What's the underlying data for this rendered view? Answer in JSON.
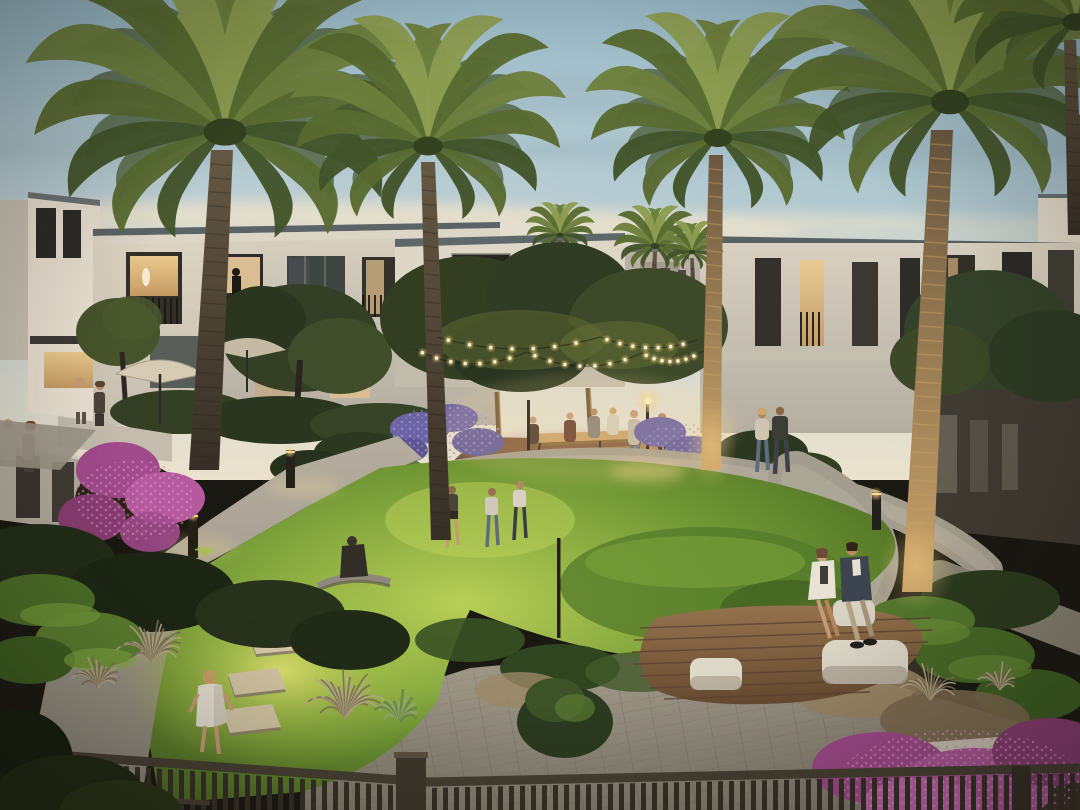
{
  "scene": {
    "type": "architectural-rendering",
    "setting": "residential community courtyard at dusk",
    "sky": "dusk sky with soft clouds",
    "landscape": [
      "palm trees",
      "communal lawn",
      "curved walkways",
      "stepping stones",
      "flowering shrubs",
      "ornamental grasses",
      "lavender beds"
    ],
    "architecture": [
      "modern two-storey townhouses",
      "balconies with lit interiors",
      "privacy walls",
      "foreground railing"
    ],
    "amenities": [
      "festoon string lights",
      "picnic tables",
      "sunken lawn bench",
      "timber deck with seat poufs",
      "patio umbrellas",
      "bollard path lights",
      "lamp post"
    ],
    "people": {
      "children_on_lawn": 3,
      "couple_seated_on_deck": 2,
      "couple_walking_on_path": 2,
      "girl_on_stepping_stones": 1,
      "person_on_lawn_bench": 1,
      "people_at_picnic_tables": 6,
      "people_on_terraces": 4,
      "silhouettes_in_doorways": 2
    }
  },
  "colors": {
    "sky_top": "#9bbccb",
    "sky_mid": "#c5d3d6",
    "sky_horizon": "#ece2cd",
    "cloud_gray": "#8fa5b0",
    "cloud_warm": "#e6ddc6",
    "building_wall": "#d8d1c2",
    "building_shaded": "#b4aea1",
    "building_white": "#e8e0d1",
    "roof": "#5c6366",
    "fascia": "#ddd6c8",
    "window_dark": "#2b2a26",
    "window_glass": "#3e4542",
    "window_warm": "#eac98f",
    "room_deep": "#c49a62",
    "doorway": "#e9c793",
    "palm_light": "#8c9c50",
    "palm_mid": "#6d7f3c",
    "palm_mid2": "#586a30",
    "palm_dark": "#42532a",
    "crown_core": "#33411f",
    "trunk_top": "#655844",
    "trunk_dark": "#372f26",
    "trunk_lit_top": "#6b573f",
    "trunk_lit": "#c9a268",
    "canopy_dark": "#323d22",
    "canopy_mid": "#46532b",
    "canopy_light": "#5e6832",
    "lawn_bright": "#b9cf57",
    "lawn_mid": "#739936",
    "lawn_dark": "#466620",
    "grass_glow": "#e0e370",
    "path_light": "#b5aea0",
    "path_mid": "#a39d8f",
    "path_dark": "#8d877b",
    "paver": "#a19a8b",
    "paver_dark": "#868072",
    "picnic_top": "#7c5940",
    "picnic_bottom": "#5d4130",
    "table_wood": "#c9a36a",
    "deck_light": "#94724d",
    "deck_dark": "#674b31",
    "pouf": "#ded8c9",
    "pouf_shade": "#b0a896",
    "lavender": "#6b63a4",
    "lavender_light": "#a49ad6",
    "boug": "#a14b8c",
    "boug_light": "#c468ae",
    "boug_dark": "#8a3d74",
    "boug_dot": "#d98ac4",
    "hedge": "#2c3820",
    "hedge_mid": "#3a4726",
    "shrub_bright": "#5d7c33",
    "dry_grass": "#9b8765",
    "silver_grass": "#b8ab88",
    "fence": "#463f33",
    "fence_bar": "#352f27",
    "fence_post": "#3e372c",
    "stone": "#d6c9a9",
    "stone_side": "#8f8468",
    "bulb_core": "#fff3cf",
    "bulb_glow": "#ffd98a",
    "skin": "#c69a74",
    "cloth_white": "#e6e0d3"
  }
}
